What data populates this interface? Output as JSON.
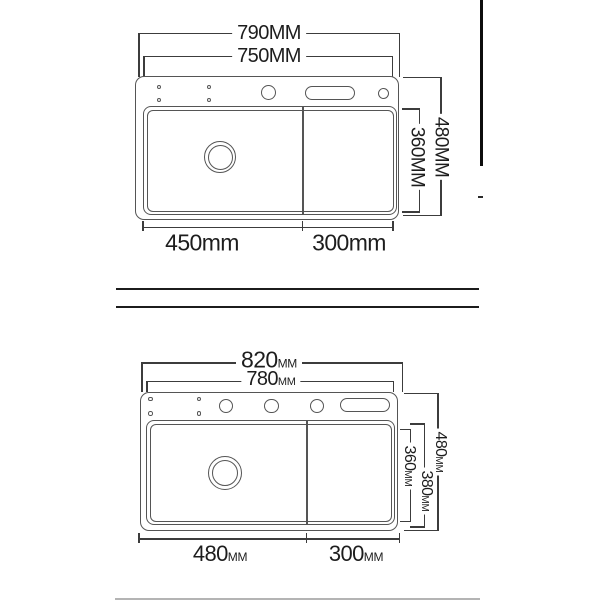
{
  "colors": {
    "background": "#ffffff",
    "line": "#555555",
    "dimension": "#3c3c3c",
    "text": "#1d1d1d",
    "divider_dark": "#1c1c1c",
    "divider_light": "#b4b4b4",
    "edge_bar": "#0d0d0d"
  },
  "top_drawing": {
    "labels": {
      "outer_width": "790MM",
      "inner_width": "750MM",
      "outer_height": "480MM",
      "inner_height": "360MM",
      "left_bottom_width": "450mm",
      "right_bottom_width": "300mm"
    }
  },
  "bottom_drawing": {
    "labels": {
      "outer_width": {
        "value": "820",
        "unit": "MM"
      },
      "inner_width": {
        "value": "780",
        "unit": "MM"
      },
      "outer_height": {
        "value": "480",
        "unit": "MM"
      },
      "mid_height": {
        "value": "380",
        "unit": "MM"
      },
      "inner_height": {
        "value": "360",
        "unit": "MM"
      },
      "left_bottom_width": {
        "value": "480",
        "unit": "MM"
      },
      "right_bottom_width": {
        "value": "300",
        "unit": "MM"
      }
    }
  }
}
